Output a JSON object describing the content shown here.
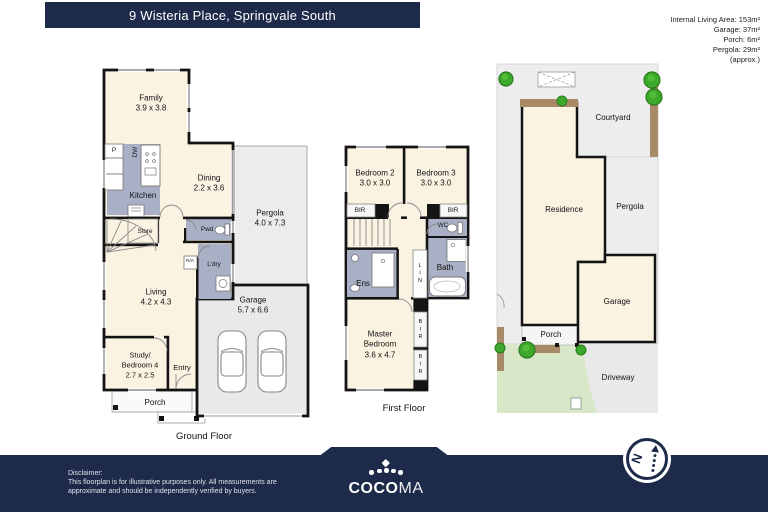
{
  "header": {
    "title": "9 Wisteria Place, Springvale South",
    "areas": [
      "Internal Living Area: 153m²",
      "Garage: 37m²",
      "Porch: 6m²",
      "Pergola: 29m²",
      "(approx.)"
    ]
  },
  "ground_floor": {
    "label": "Ground Floor",
    "rooms": {
      "family": {
        "name": "Family",
        "dims": "3.9 x 3.8"
      },
      "kitchen": {
        "name": "Kitchen"
      },
      "dishwasher": {
        "name": "DW"
      },
      "pantry": {
        "name": "P"
      },
      "dining": {
        "name": "Dining",
        "dims": "2.2 x 3.6"
      },
      "pergola": {
        "name": "Pergola",
        "dims": "4.0 x 7.3"
      },
      "store": {
        "name": "Store"
      },
      "powder": {
        "name": "Pwd"
      },
      "return_air": {
        "name": "R/A"
      },
      "laundry": {
        "name": "L'dry"
      },
      "living": {
        "name": "Living",
        "dims": "4.2 x 4.3"
      },
      "garage": {
        "name": "Garage",
        "dims": "5.7 x 6.6"
      },
      "study": {
        "name1": "Study/",
        "name2": "Bedroom 4",
        "dims": "2.7 x 2.5"
      },
      "entry": {
        "name": "Entry"
      },
      "porch": {
        "name": "Porch"
      }
    }
  },
  "first_floor": {
    "label": "First Floor",
    "rooms": {
      "bedroom2": {
        "name": "Bedroom 2",
        "dims": "3.0 x 3.0"
      },
      "bedroom3": {
        "name": "Bedroom 3",
        "dims": "3.0 x 3.0"
      },
      "bir_left": {
        "name": "BIR"
      },
      "bir_right": {
        "name": "BIR"
      },
      "wc": {
        "name": "WC"
      },
      "bath": {
        "name": "Bath"
      },
      "ensuite": {
        "name": "Ens"
      },
      "linen": {
        "name": "LIN"
      },
      "master": {
        "name1": "Master",
        "name2": "Bedroom",
        "dims": "3.6 x 4.7"
      },
      "bir_v1": {
        "name": "BIR"
      },
      "bir_v2": {
        "name": "BIR"
      }
    }
  },
  "site_plan": {
    "courtyard": "Courtyard",
    "residence": "Residence",
    "pergola": "Pergola",
    "garage": "Garage",
    "porch": "Porch",
    "driveway": "Driveway"
  },
  "footer": {
    "disclaimer_title": "Disclaimer:",
    "disclaimer_line1": "This floorplan is for illustrative purposes only. All measurements are",
    "disclaimer_line2": "approximate and should be independently verified by buyers.",
    "brand_bold": "COCO",
    "brand_light": "MA",
    "compass_letter": "N"
  },
  "icons": {
    "crown": "crown-of-dots-icon",
    "compass": "north-compass-icon",
    "tree": "tree-icon",
    "car": "car-top-view-icon",
    "bathtub": "bathtub-icon",
    "toilet": "toilet-icon",
    "stairs": "stairs-icon"
  },
  "colors": {
    "navy": "#1E2A4A",
    "room_cream": "#FAF3E2",
    "wet_area_gray": "#A9AFC4",
    "hard_surface_gray": "#ECECEC",
    "lawn_green": "#D9E7C9",
    "timber_brown": "#A98A68",
    "tree_green": "#3DA92C",
    "wall_black": "#141414"
  }
}
